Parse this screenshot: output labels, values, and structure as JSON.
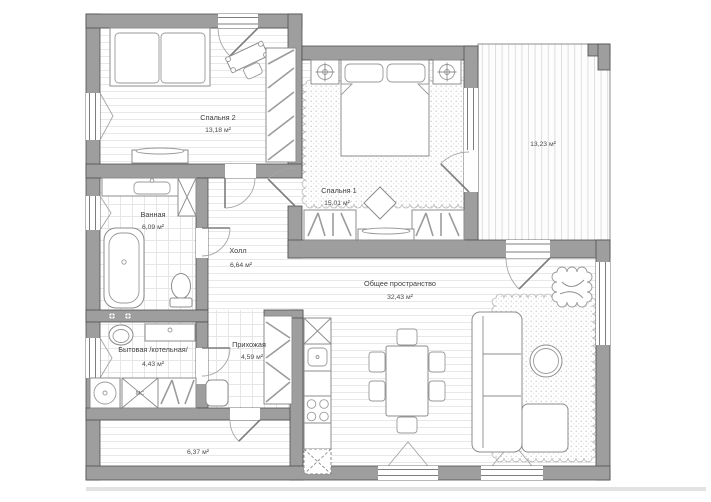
{
  "plan": {
    "rooms": {
      "bedroom2": {
        "name": "Спальня 2",
        "area": "13,18 м²"
      },
      "bedroom1": {
        "name": "Спальня 1",
        "area": "15,01 м²"
      },
      "bathroom": {
        "name": "Ванная",
        "area": "6,09 м²"
      },
      "hall": {
        "name": "Холл",
        "area": "6,64 м²"
      },
      "utility": {
        "name": "Бытовая /котельная/",
        "area": "4,43 м²"
      },
      "entry": {
        "name": "Прихожая",
        "area": "4,59 м²"
      },
      "common": {
        "name": "Общее пространство",
        "area": "32,43 м²"
      },
      "terrace": {
        "area": "13,23 м²"
      },
      "porch": {
        "area": "6,37 м²"
      }
    },
    "appliances": {
      "washer_label": "МС"
    },
    "colors": {
      "wall": "#9e9e9e",
      "wall_outline": "#4f4f4f",
      "floor_line": "#e8e8e8",
      "carpet_dot": "#c7c7c7",
      "label_text": "#3e3e3e"
    }
  }
}
